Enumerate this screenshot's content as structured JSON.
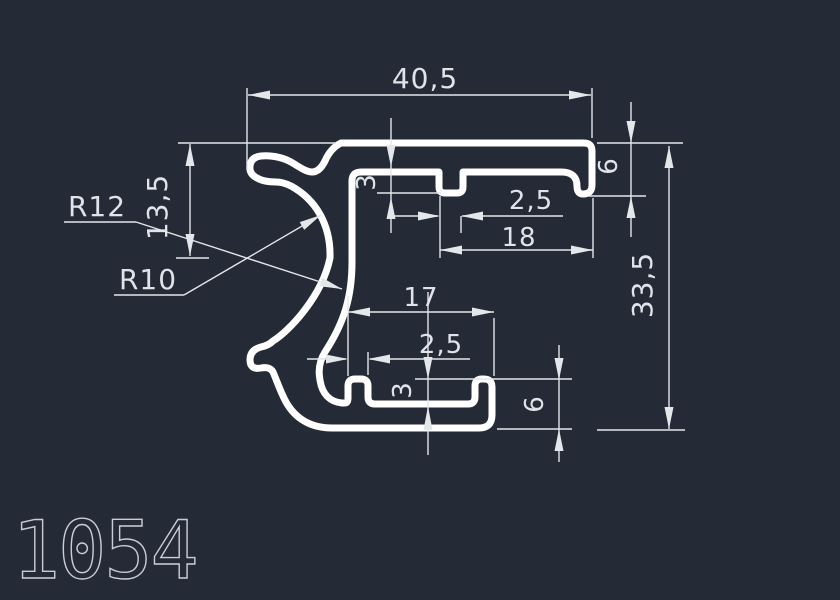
{
  "colors": {
    "background": "#242a36",
    "profile_line": "#ffffff",
    "dimension_line": "#e4e7ea",
    "dimension_text": "#e0e3e7",
    "drawing_number_text": "#c9ced6"
  },
  "drawing": {
    "profile_name": "1054",
    "dimensions": {
      "overall_width": "40,5",
      "overall_height": "33,5",
      "left_top_offset": "13,5",
      "outer_radius": "R12",
      "inner_radius": "R10",
      "top_groove_depth": "3",
      "top_groove_width": "2,5",
      "top_groove_to_edge": "18",
      "top_right_lip_height": "6",
      "bottom_channel_span": "17",
      "bottom_lip_width": "2,5",
      "bottom_groove_depth": "3",
      "bottom_right_lip_height": "6"
    }
  }
}
